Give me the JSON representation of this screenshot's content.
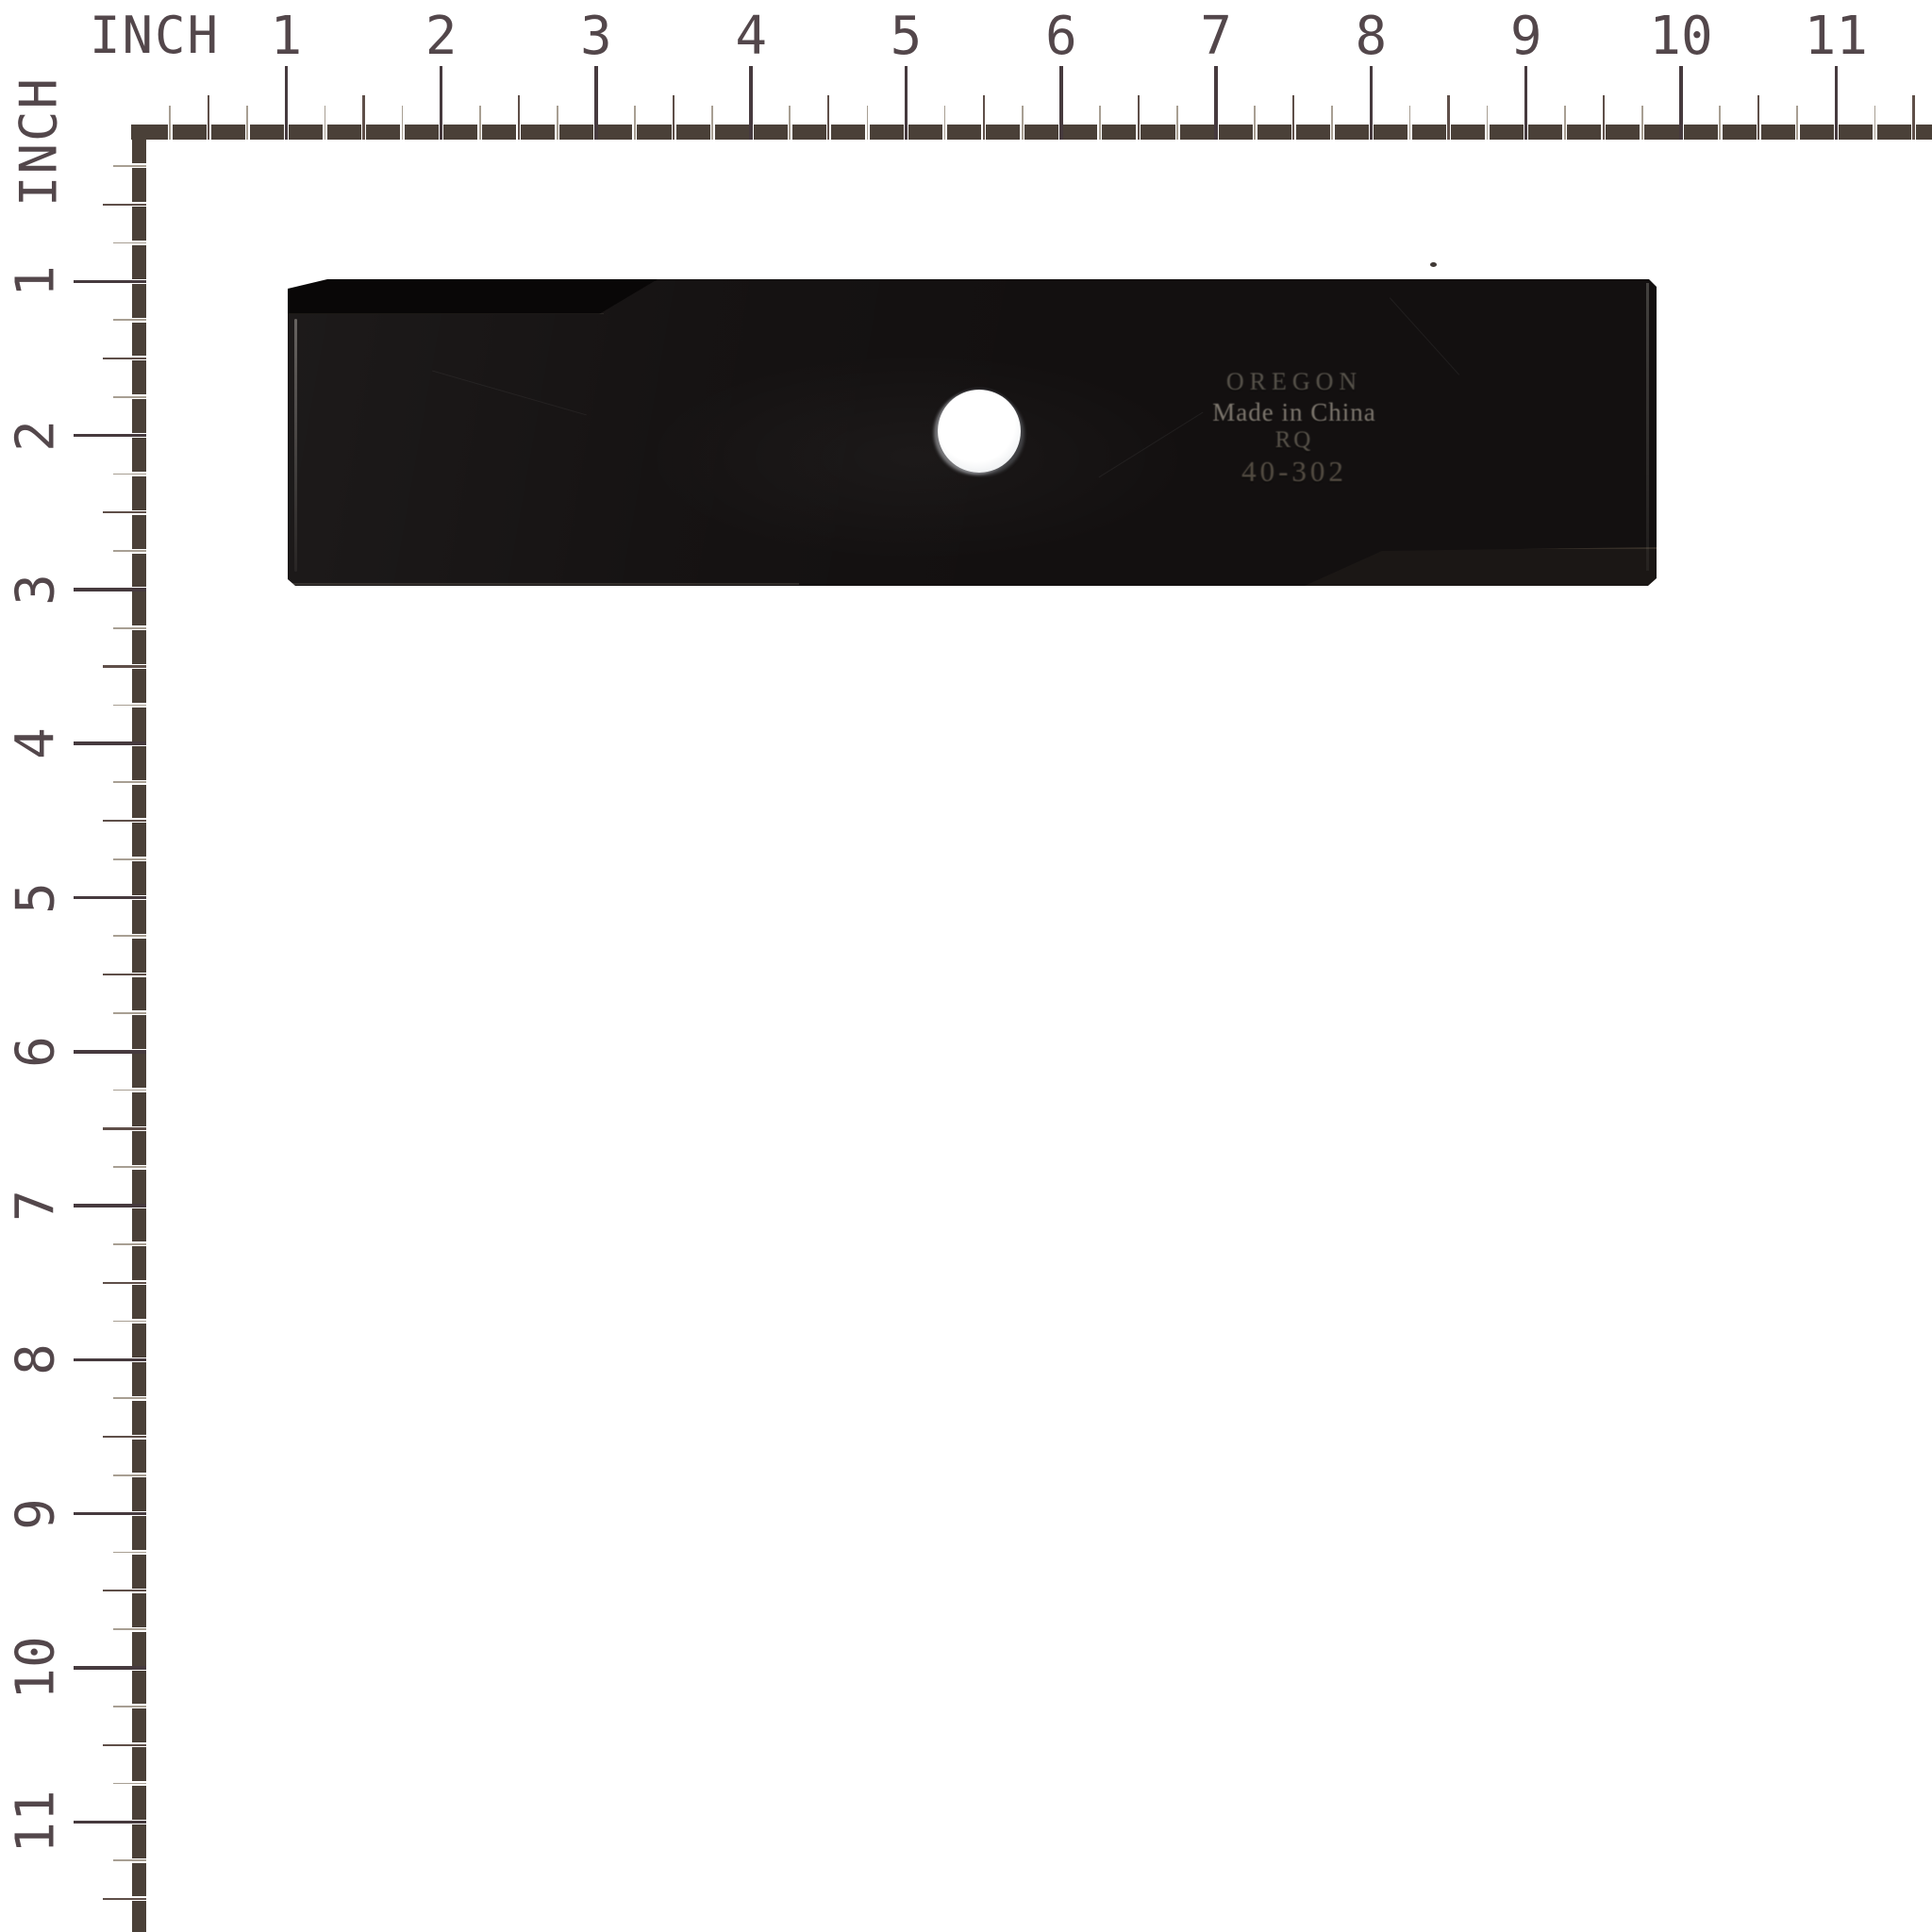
{
  "top_ruler": {
    "unit": "INCH",
    "numbers": [
      "1",
      "2",
      "3",
      "4",
      "5",
      "6",
      "7",
      "8",
      "9",
      "10",
      "11"
    ]
  },
  "left_ruler": {
    "unit": "INCH",
    "numbers": [
      "1",
      "2",
      "3",
      "4",
      "5",
      "6",
      "7",
      "8",
      "9",
      "10",
      "11"
    ]
  },
  "blade": {
    "stamp": {
      "brand": "OREGON",
      "origin": "Made in China",
      "code": "RQ",
      "part_number": "40-302"
    }
  },
  "colors": {
    "background": "#ffffff",
    "ruler_bar": "#4a4038",
    "tick_inch": "#463a3e",
    "tick_half": "#5f4f49",
    "tick_quarter": "#a89f93",
    "ruler_number": "#53474b",
    "blade_black": "#131010",
    "stamp_text": "#a79d8d",
    "hole_white": "#ffffff"
  }
}
